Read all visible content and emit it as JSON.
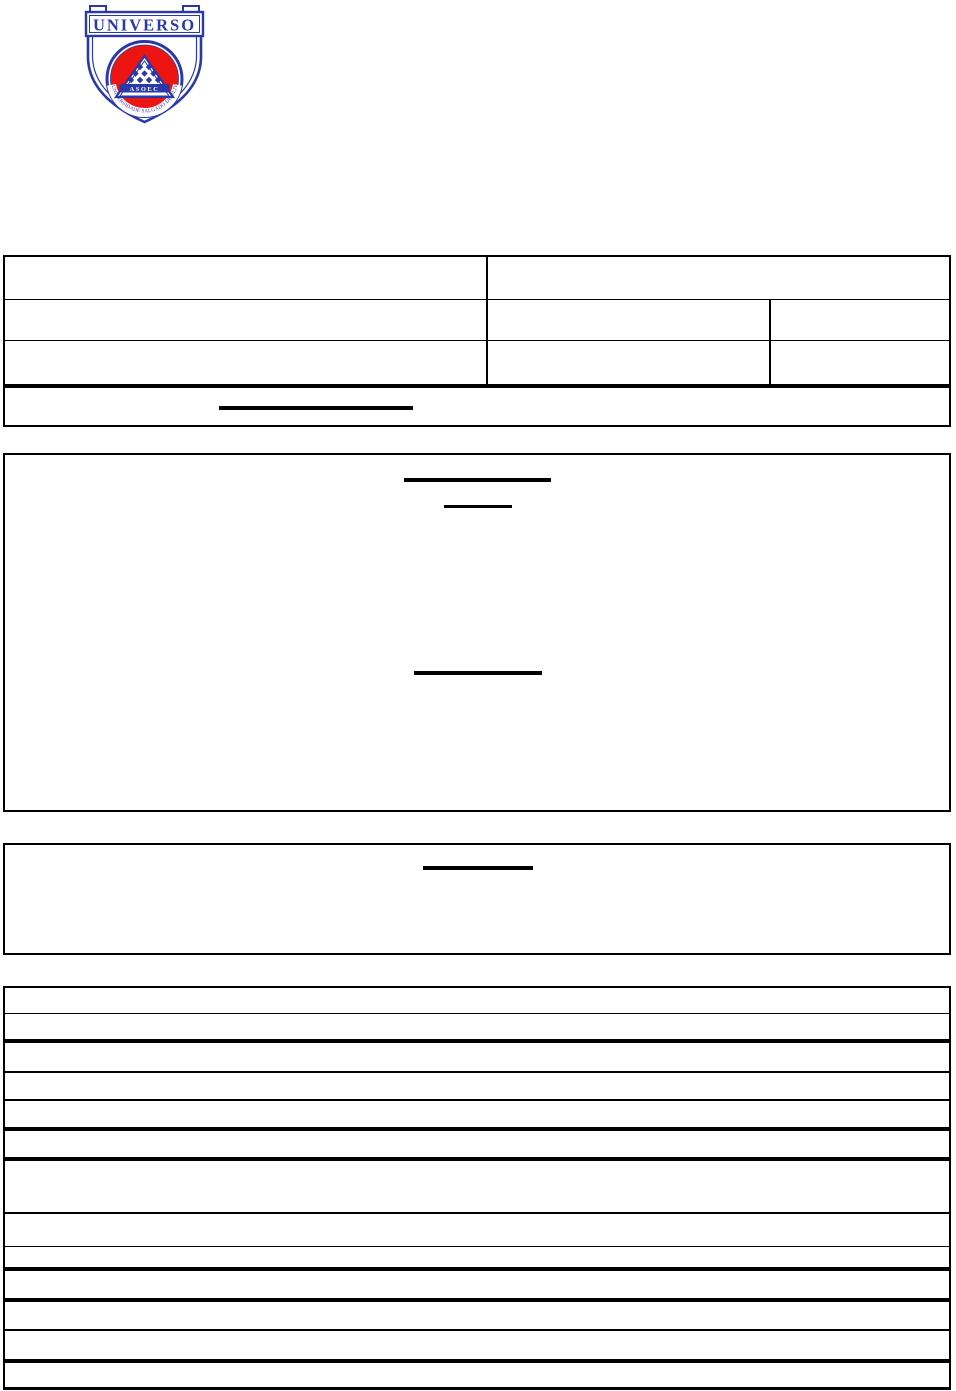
{
  "page": {
    "background": "#ffffff",
    "rule_color": "#000000"
  },
  "logo": {
    "banner_text": "UNIVERSO",
    "band_text": "ASOEC",
    "circular_text": "UNIVERSIDADE SALGADO DE OLIVEIRA",
    "colors": {
      "blue": "#2b38a8",
      "red": "#ec1512",
      "white": "#ffffff"
    }
  },
  "header_table": {
    "rows": [
      {
        "cells": [
          "",
          ""
        ]
      },
      {
        "cells": [
          "",
          "",
          ""
        ]
      },
      {
        "cells": [
          "",
          "",
          ""
        ]
      },
      {
        "cells": [
          ""
        ]
      }
    ]
  },
  "upper_box": {
    "text": ""
  },
  "lower_box": {
    "text": ""
  },
  "detail_table": {
    "row_count": 13,
    "rows": [
      "",
      "",
      "",
      "",
      "",
      "",
      "",
      "",
      "",
      "",
      "",
      "",
      ""
    ]
  }
}
